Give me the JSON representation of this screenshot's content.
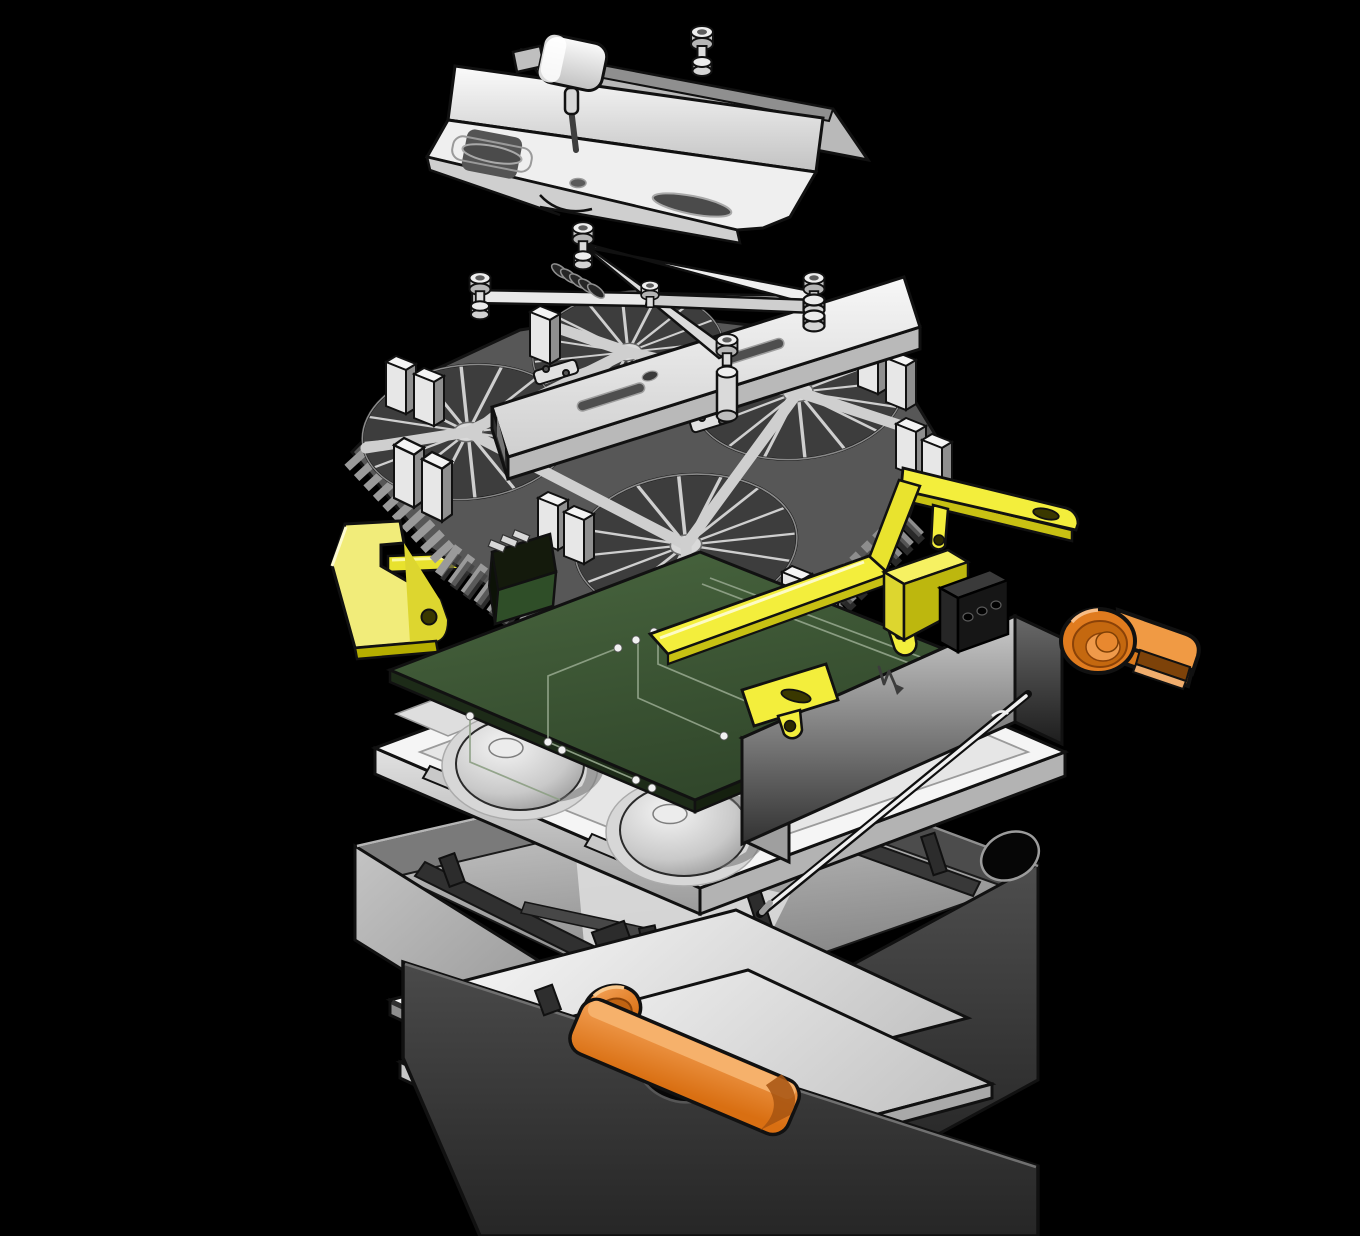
{
  "canvas": {
    "width": 1360,
    "height": 1236,
    "background": "#000000"
  },
  "illustration": {
    "title": "Exploded isometric view of a rugged fanless embedded computer assembly",
    "type": "technical-illustration",
    "text_visible": "none"
  },
  "parts": [
    {
      "id": 0,
      "label": "DIN-rail mounting bracket with clip knob and slotted holes",
      "color": "#f2f2f2"
    },
    {
      "id": 1,
      "label": "captive thumb screw with washer",
      "color": "#e8e8e8"
    },
    {
      "id": 2,
      "label": "spring-loaded X retention clip with four captive screws",
      "color": "#e3e3e3"
    },
    {
      "id": 3,
      "label": "slotted rectangular cross-bar tube",
      "color": "#ededed"
    },
    {
      "id": 4,
      "label": "radial-fin aluminium heatsink with corner standoffs",
      "color": "#8b8b8b"
    },
    {
      "id": 5,
      "label": "yellow side bracket plate with hole",
      "color": "#f0e926"
    },
    {
      "id": 6,
      "label": "yellow retention frame with slotted arms and tabs",
      "color": "#f3ee3c"
    },
    {
      "id": 7,
      "label": "black connector block with three holes",
      "color": "#2a2a2a"
    },
    {
      "id": 8,
      "label": "green printed circuit board with traces and pads",
      "color": "#3e5a36"
    },
    {
      "id": 9,
      "label": "vertical connector riser card with pins",
      "color": "#2f4e28"
    },
    {
      "id": 10,
      "label": "grey heat-spreader module block",
      "color": "#bdbdbd"
    },
    {
      "id": 11,
      "label": "zigzag arrow brand mark on module block",
      "color": "#3c3c3c"
    },
    {
      "id": 12,
      "label": "steel hinge pin rod",
      "color": "#f0f0f0"
    },
    {
      "id": 13,
      "label": "white thermal tray with two conical domes and notched rim",
      "color": "#f5f5f5"
    },
    {
      "id": 14,
      "label": "dark chassis housing with compartments and side holes",
      "color": "#3a3a3a"
    },
    {
      "id": 15,
      "label": "front chassis frame with oval cutout",
      "color": "#383838"
    },
    {
      "id": 16,
      "label": "orange latch handle through front frame",
      "color": "#e8802b"
    },
    {
      "id": 17,
      "label": "orange release lever with round boss",
      "color": "#e07b1e"
    },
    {
      "id": 18,
      "label": "middle base plate",
      "color": "#e9e9e9"
    },
    {
      "id": 19,
      "label": "bottom cover plate",
      "color": "#fdfdfd"
    }
  ],
  "palette": {
    "outline": "#121212",
    "metal_light": "#f2f2f2",
    "metal_mid": "#bdbdbd",
    "metal_dark": "#6b6b6b",
    "chassis_dark": "#2f2f2f",
    "yellow": "#f0e926",
    "yellow_shade": "#b5ae00",
    "pcb_green": "#3e5a36",
    "pcb_green_dark": "#24361f",
    "orange": "#e8802b",
    "orange_dark": "#a14e0e",
    "background": "#000000"
  }
}
